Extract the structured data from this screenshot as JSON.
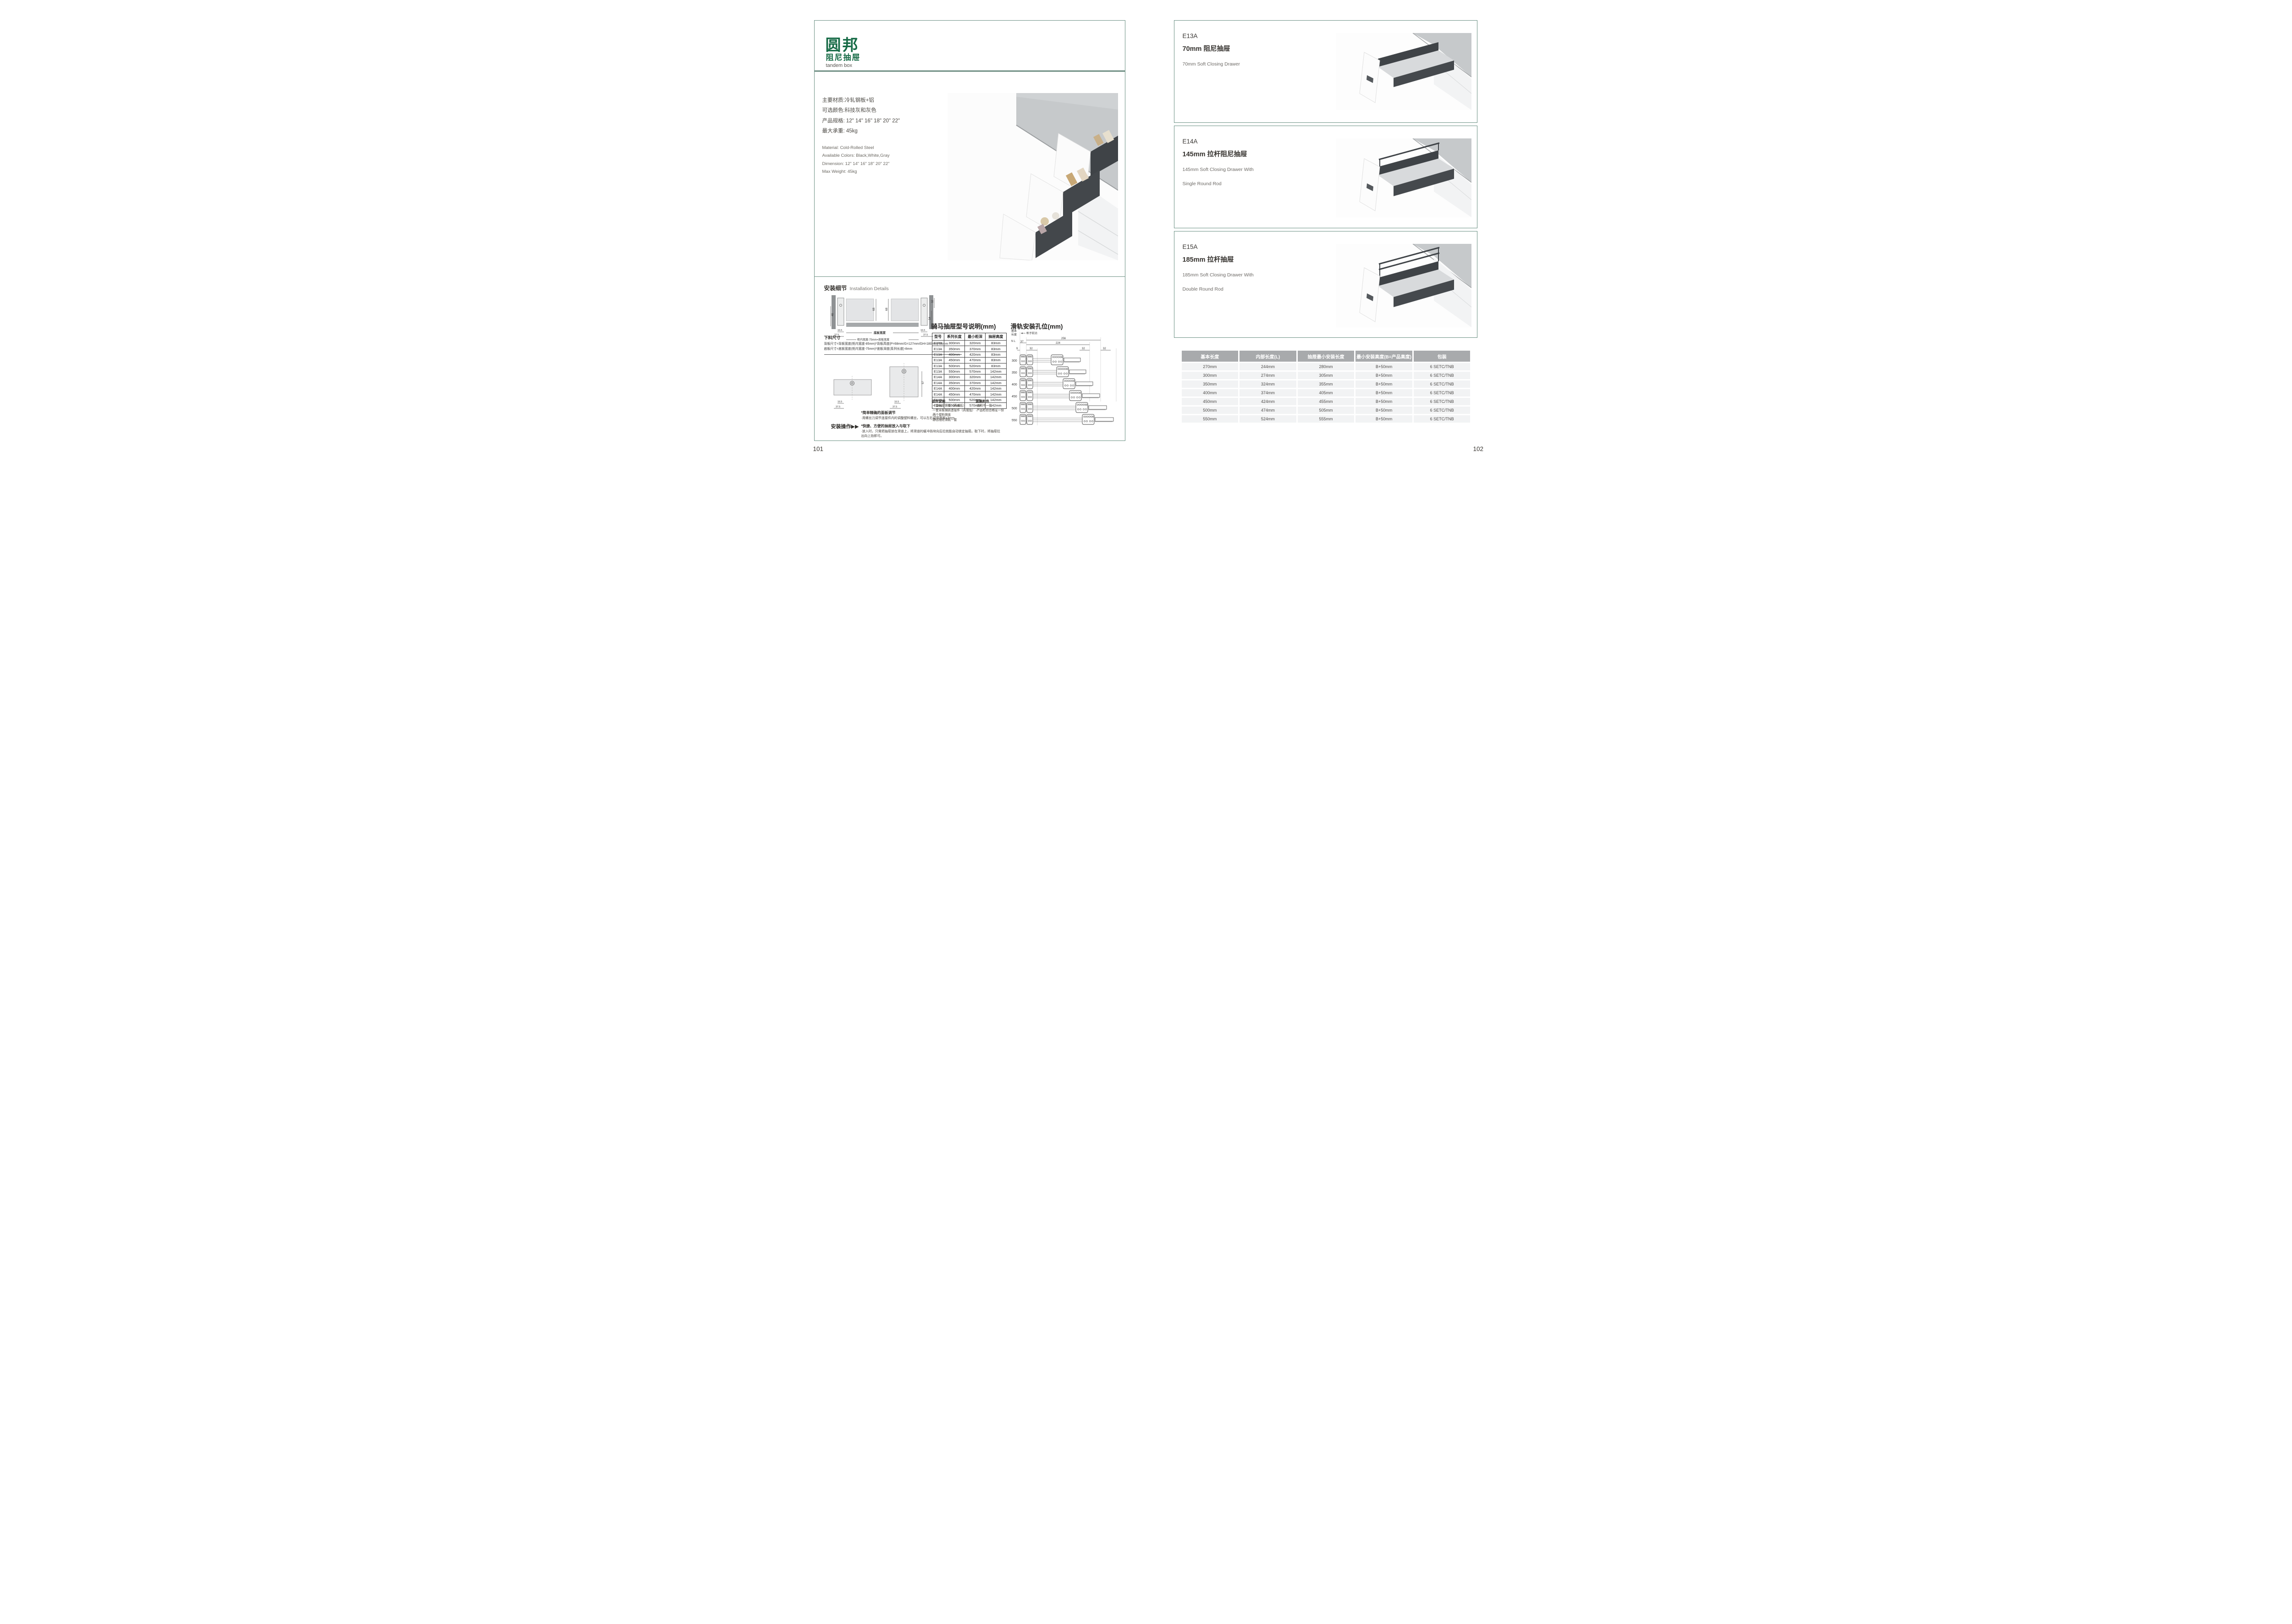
{
  "colors": {
    "brand-green": "#156a45",
    "frame": "#6b9083",
    "divider": "#2e5b4c",
    "ink": "#3e3a36",
    "th-bg": "#a8aaac",
    "tr-bg": "#f2f3f4",
    "counter": "#c6c9cb",
    "dark": "#3f4347",
    "mid": "#d8dadc"
  },
  "brand": {
    "logo": "圆邦",
    "subtitle": "阻尼抽屉",
    "tagline": "tandem box"
  },
  "left_page": {
    "page_number": "101",
    "specs_cn": [
      "主要材质:冷轧钢板+铝",
      "可选颜色:科技灰和灰色",
      "产品规格: 12\" 14\" 16\" 18\" 20\" 22\"",
      "最大承重: 45kg"
    ],
    "specs_en": [
      "Material: Cold-Rolled Steel",
      "Available Colors: Black,White,Gray",
      "Dimension: 12\" 14\" 16\" 18\" 20\" 22\"",
      "Max Weight: 45kg"
    ],
    "installation": {
      "heading_cn": "安装细节",
      "heading_en": "Installation Details",
      "cross": {
        "d68a": "68",
        "d68b": "68",
        "d32": "32",
        "d46": "46",
        "d54": "54",
        "d165a": "16.5",
        "d375a": "37.5",
        "d165b": "16.5",
        "d375b": "37.5",
        "bottom_width": "底板宽度",
        "formula_width": "柜内宽度-75mm=底板宽度"
      },
      "cutting": {
        "heading": "下料尺寸",
        "f1": "背板尺寸=背板宽度(柜内宽度-85mm)*背板高度(P=68mm/G=127mm/GH=180mm)*16mm",
        "f2": "底板尺寸=底板宽度(柜内宽度-75mm)*底板深度(系列长度)-8mm",
        "d57": "57",
        "d165a": "16.5",
        "d375a": "37.5",
        "d165b": "16.5",
        "d375b": "37.5"
      },
      "operation": {
        "label": "安装操作",
        "arrows": "▶▶"
      },
      "notes": [
        {
          "title": "*简单精确的面板调节",
          "body": "·用螺丝刀调节连接件内的调整塑料螺丝，可以左右调节面板±3mm"
        },
        {
          "title": "*快捷、方便的抽屉放入与取下",
          "body": "·放入时，只需把抽屉放在滑道上，将滑道的缓冲挡块向后拉就能自动锁定抽屉。取下时，将抽屉拉出向上抬即可。"
        }
      ],
      "components": {
        "heading": "组件说明",
        "items": [
          "·一套抽屉侧板（高或低）",
          "·一套背板钢质连接件（高或低）",
          "·两个塑料侧盖",
          "·静音阻尼滑轨一套"
        ]
      },
      "packing": {
        "heading": "装箱附件",
        "items": [
          "·说明书一份",
          "·产品检验合格证一份"
        ]
      }
    },
    "model_table": {
      "title": "骑马抽屉型号说明(mm)",
      "headers": [
        "型号",
        "系列长度",
        "最小柜深",
        "抽屉高度"
      ],
      "rows": [
        [
          "E13A",
          "300mm",
          "320mm",
          "83mm"
        ],
        [
          "E13A",
          "350mm",
          "370mm",
          "83mm"
        ],
        [
          "E13A",
          "400mm",
          "420mm",
          "83mm"
        ],
        [
          "E13A",
          "450mm",
          "470mm",
          "83mm"
        ],
        [
          "E13A",
          "500mm",
          "520mm",
          "83mm"
        ],
        [
          "E13A",
          "550mm",
          "570mm",
          "142mm"
        ],
        [
          "E14A",
          "300mm",
          "320mm",
          "142mm"
        ],
        [
          "E14A",
          "350mm",
          "370mm",
          "142mm"
        ],
        [
          "E14A",
          "400mm",
          "420mm",
          "142mm"
        ],
        [
          "E14A",
          "450mm",
          "470mm",
          "142mm"
        ],
        [
          "E14A",
          "500mm",
          "520mm",
          "142mm"
        ],
        [
          "E14A",
          "550mm",
          "570mm",
          "142mm"
        ]
      ]
    },
    "rail_diagram": {
      "title": "滑轨安装孔位(mm)",
      "axis1": "基本",
      "axis2": "长度",
      "axis3": "N L",
      "front_edge": "柜子前沿",
      "d256": "256",
      "d224": "224",
      "d37": "37",
      "d9": "9",
      "d32a": "32",
      "d32b": "32",
      "d32c": "32",
      "lengths": [
        "300",
        "350",
        "400",
        "450",
        "500",
        "550"
      ]
    }
  },
  "right_page": {
    "page_number": "102",
    "products": [
      {
        "model": "E13A",
        "title_cn": "70mm 阻尼抽屉",
        "en1": "70mm Soft Closing Drawer",
        "en2": ""
      },
      {
        "model": "E14A",
        "title_cn": "145mm 拉杆阻尼抽屉",
        "en1": "145mm Soft Closing Drawer With",
        "en2": "Single Round Rod"
      },
      {
        "model": "E15A",
        "title_cn": "185mm 拉杆抽屉",
        "en1": "185mm Soft Closing Drawer With",
        "en2": "Double Round Rod"
      }
    ],
    "size_table": {
      "headers": [
        "基本长度",
        "内部长度(L)",
        "抽屉最小安装长度",
        "最小安装高度(B=产品高度)",
        "包装"
      ],
      "rows": [
        [
          "270mm",
          "244mm",
          "280mm",
          "B+50mm",
          "6 SETC/TNB"
        ],
        [
          "300mm",
          "274mm",
          "305mm",
          "B+50mm",
          "6 SETC/TNB"
        ],
        [
          "350mm",
          "324mm",
          "355mm",
          "B+50mm",
          "6 SETC/TNB"
        ],
        [
          "400mm",
          "374mm",
          "405mm",
          "B+50mm",
          "6 SETC/TNB"
        ],
        [
          "450mm",
          "424mm",
          "455mm",
          "B+50mm",
          "6 SETC/TNB"
        ],
        [
          "500mm",
          "474mm",
          "505mm",
          "B+50mm",
          "6 SETC/TNB"
        ],
        [
          "550mm",
          "524mm",
          "555mm",
          "B+50mm",
          "6 SETC/TNB"
        ]
      ]
    }
  }
}
